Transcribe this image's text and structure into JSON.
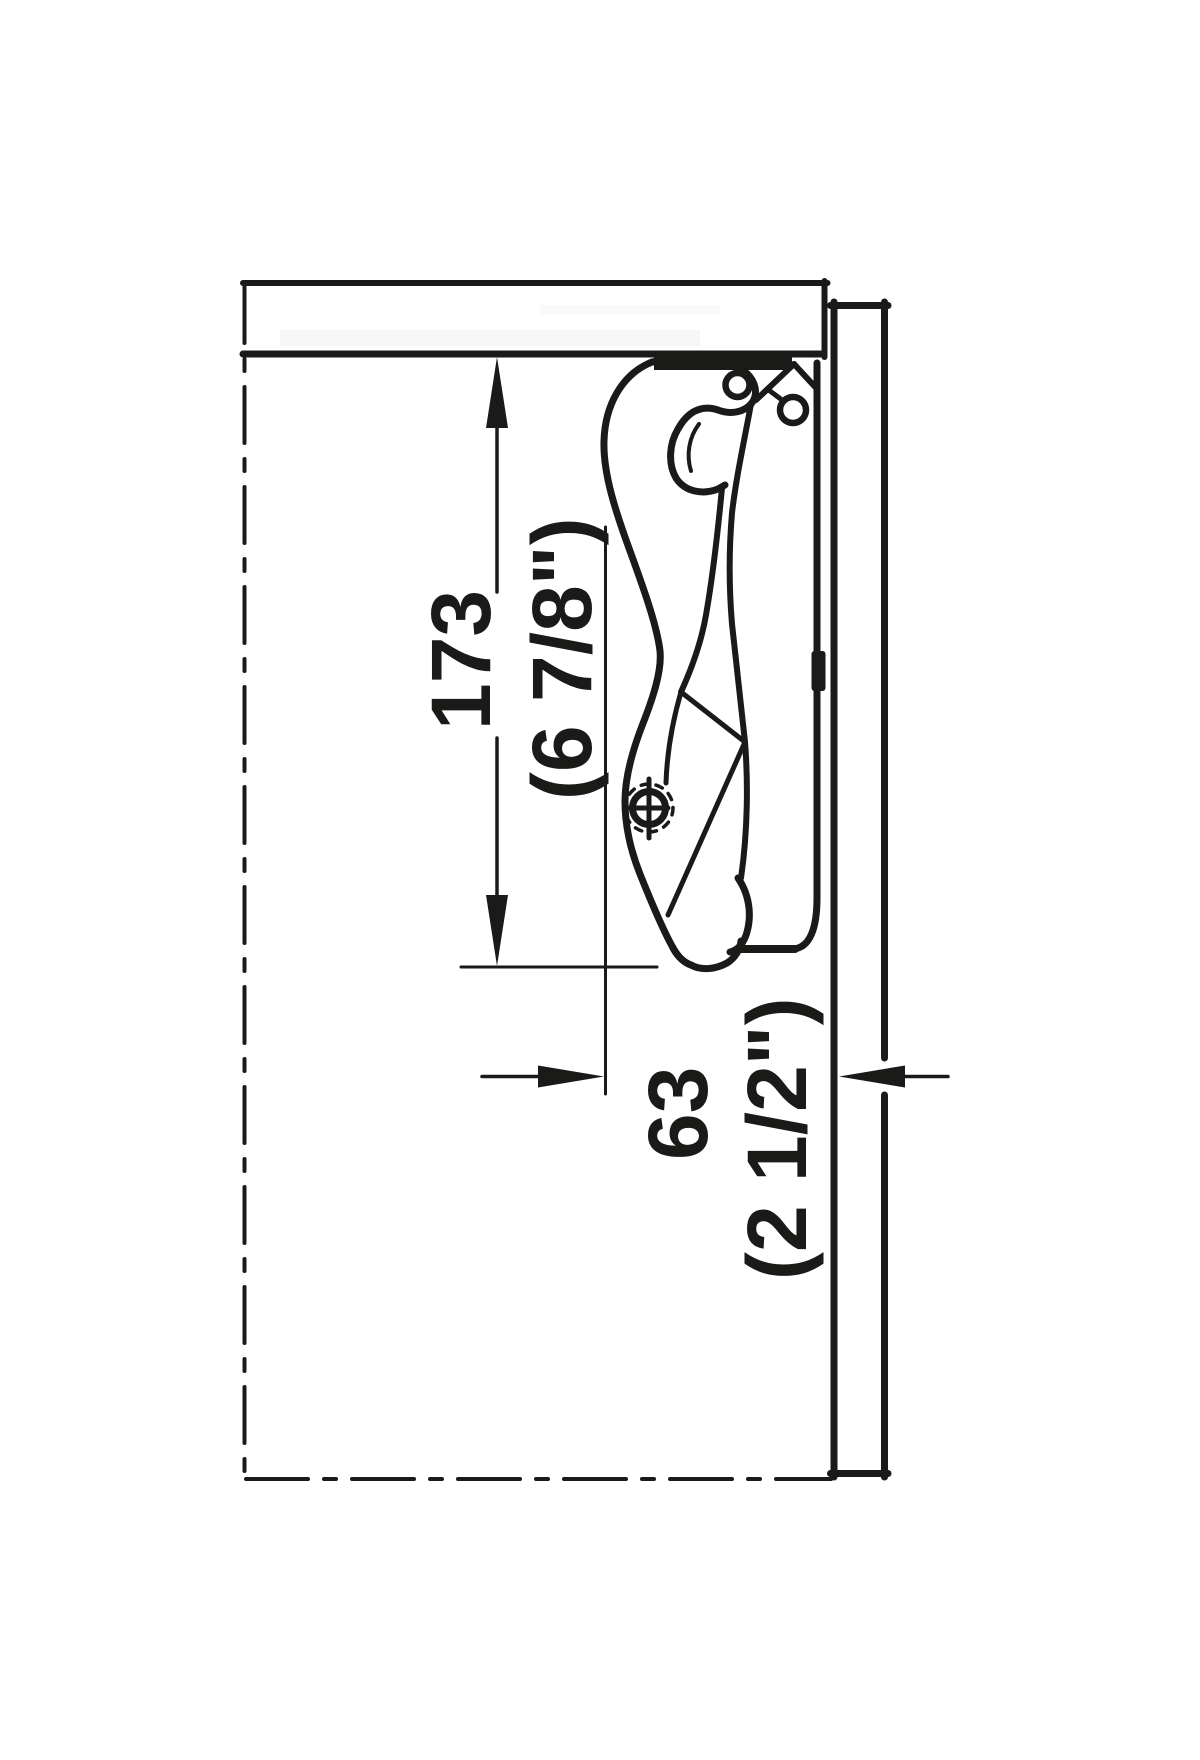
{
  "diagram": {
    "type": "technical-installation-drawing",
    "background": "#ffffff",
    "line_color": "#1a1a19",
    "height_dimension": {
      "mm": "173",
      "inch": "(6 7/8\")"
    },
    "depth_dimension": {
      "mm": "63",
      "inch": "(2 1/2\")"
    }
  }
}
